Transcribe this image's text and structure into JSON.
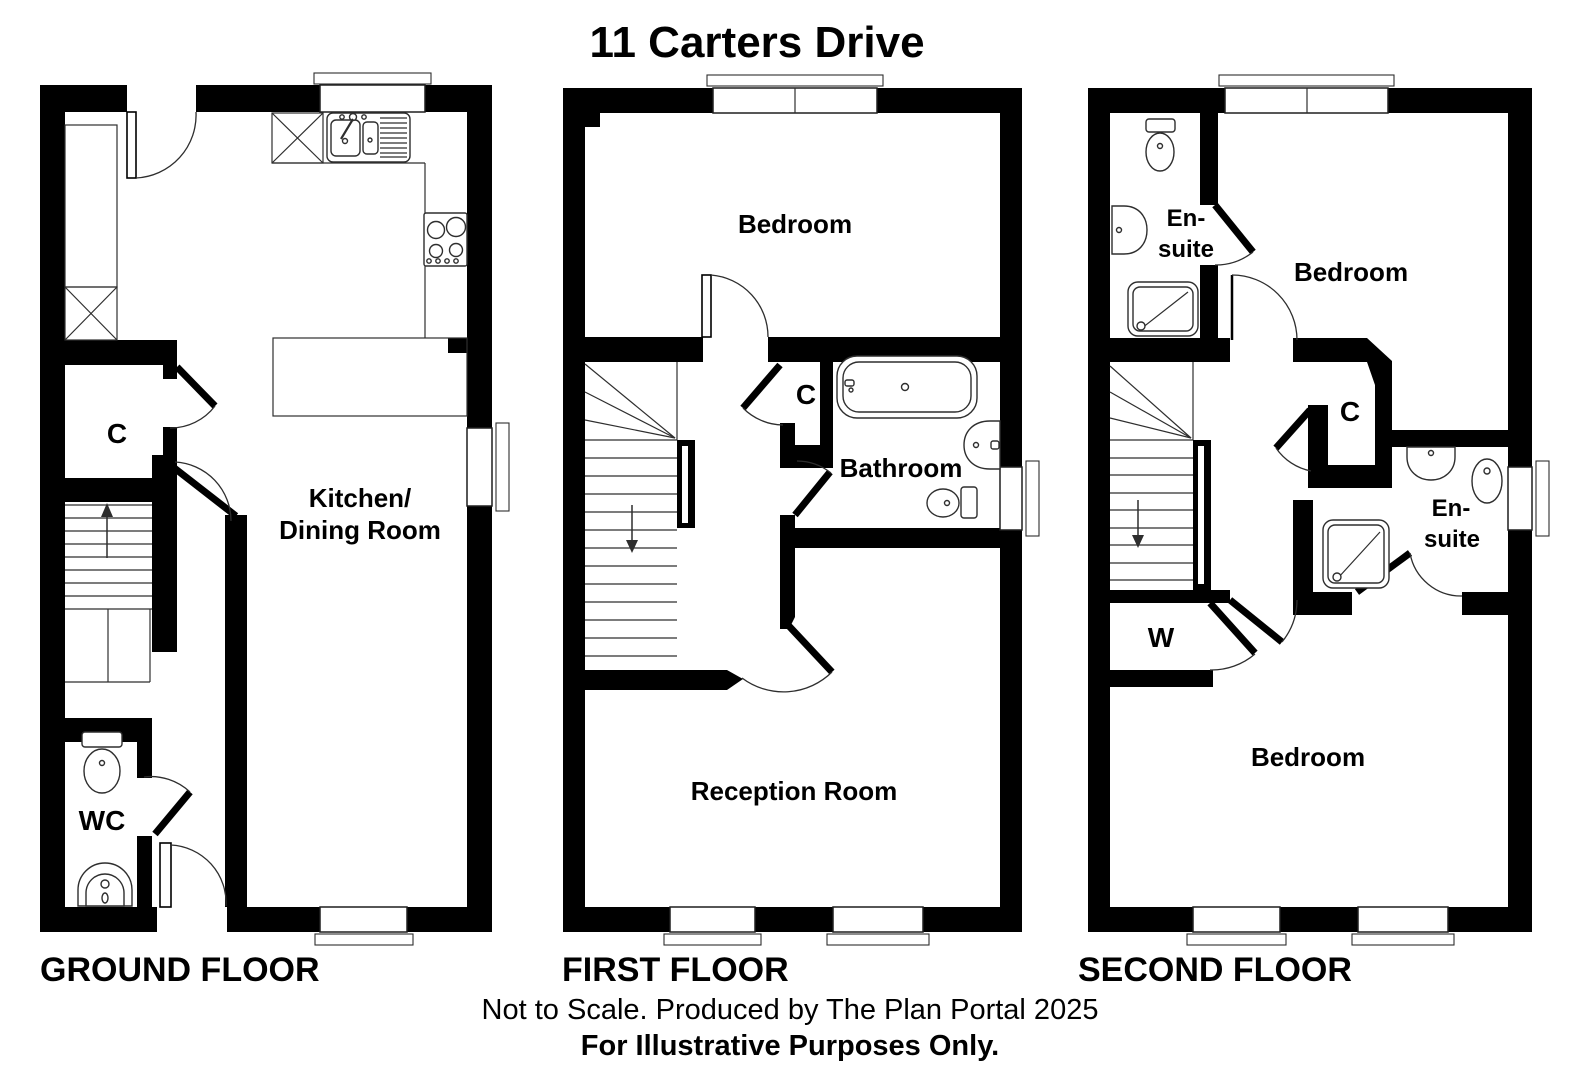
{
  "title": "11 Carters Drive",
  "footer": {
    "line1": "Not to Scale. Produced by The Plan Portal 2025",
    "line2": "For Illustrative Purposes Only."
  },
  "floors": {
    "ground": {
      "name": "GROUND FLOOR",
      "rooms": {
        "closet": "C",
        "kitchen_line1": "Kitchen/",
        "kitchen_line2": "Dining Room",
        "wc": "WC"
      }
    },
    "first": {
      "name": "FIRST FLOOR",
      "rooms": {
        "bedroom": "Bedroom",
        "closet": "C",
        "bathroom": "Bathroom",
        "reception": "Reception Room"
      }
    },
    "second": {
      "name": "SECOND FLOOR",
      "rooms": {
        "ensuite1_line1": "En-",
        "ensuite1_line2": "suite",
        "bedroom_top": "Bedroom",
        "closet": "C",
        "ensuite2_line1": "En-",
        "ensuite2_line2": "suite",
        "wardrobe": "W",
        "bedroom_bottom": "Bedroom"
      }
    }
  }
}
